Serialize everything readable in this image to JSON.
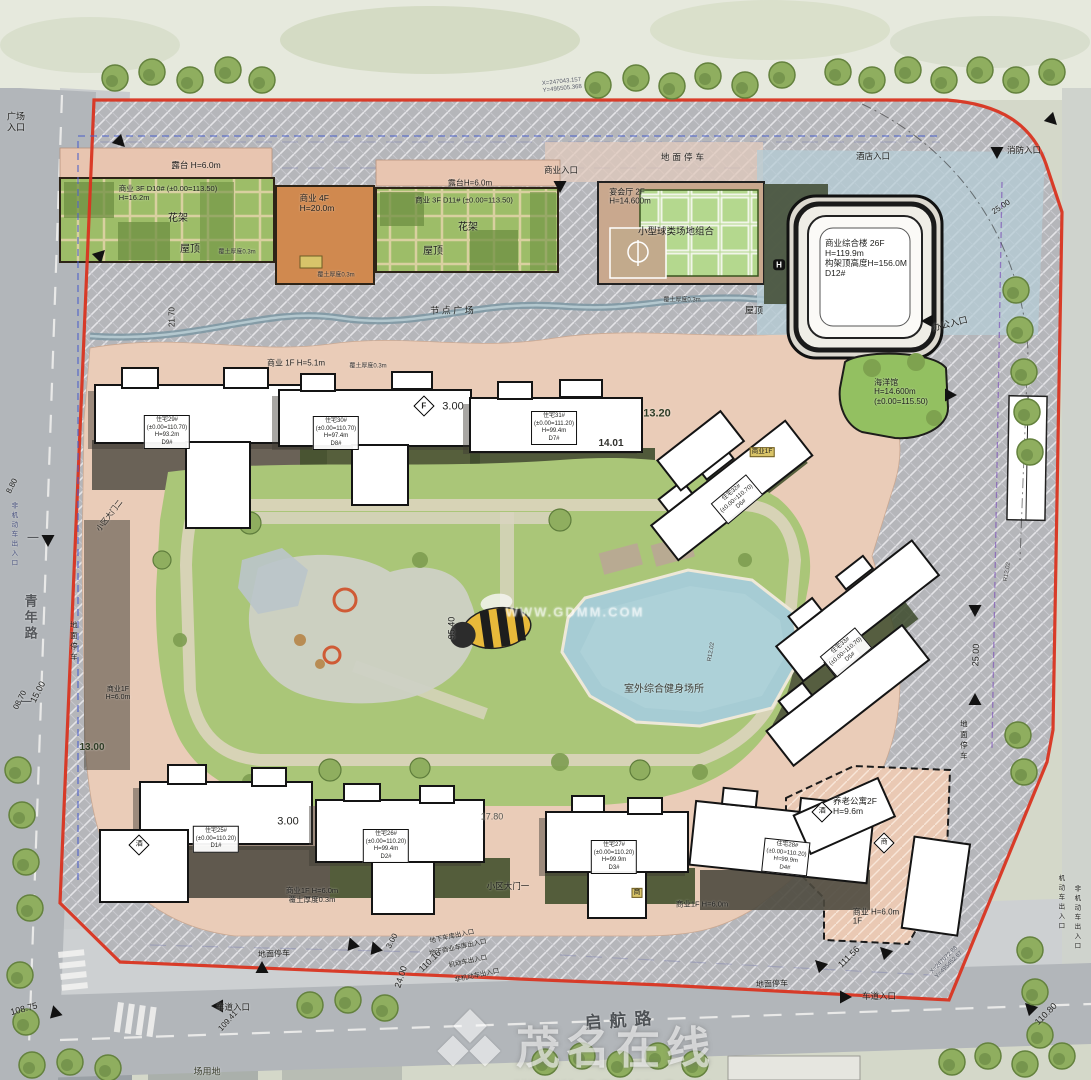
{
  "watermark": {
    "brand": "茂名在线",
    "url": "WWW.GDMM.COM"
  },
  "roads": {
    "left": "青年路",
    "bottom": "启航路"
  },
  "accent_colors": {
    "boundary_red": "#d93420",
    "lawn_green": "#aac678",
    "pool_blue": "#a6ccd4",
    "walk_pink": "#eaccb8"
  },
  "labels": [
    {
      "n": "plaza-entrance-fragment",
      "t": "广场\n入口",
      "x": 16,
      "y": 122,
      "fs": 9
    },
    {
      "n": "terrace-a",
      "t": "露台 H=6.0m",
      "x": 196,
      "y": 165,
      "fs": 8.5
    },
    {
      "n": "shop-d10",
      "t": "商业 3F D10# (±0.00=113.50)\nH=16.2m",
      "x": 168,
      "y": 194,
      "fs": 7.5,
      "cls": "ta-l"
    },
    {
      "n": "pergola-a",
      "t": "花架",
      "x": 178,
      "y": 219,
      "fs": 10
    },
    {
      "n": "roof-a",
      "t": "屋顶",
      "x": 190,
      "y": 250,
      "fs": 10
    },
    {
      "n": "soil-a",
      "t": "覆土厚度0.3m",
      "x": 237,
      "y": 253,
      "fs": 6,
      "c": "#333"
    },
    {
      "n": "shop-4f",
      "t": "商业 4F\nH=20.0m",
      "x": 317,
      "y": 203,
      "fs": 8.5,
      "cls": "ta-l"
    },
    {
      "n": "soil-b",
      "t": "覆土厚度0.3m",
      "x": 336,
      "y": 276,
      "fs": 6,
      "c": "#333"
    },
    {
      "n": "terrace-b",
      "t": "露台H=6.0m",
      "x": 470,
      "y": 183,
      "fs": 8
    },
    {
      "n": "shop-d11",
      "t": "商业 3F D11# (±0.00=113.50)",
      "x": 464,
      "y": 201,
      "fs": 7.5
    },
    {
      "n": "pergola-b",
      "t": "花架",
      "x": 468,
      "y": 228,
      "fs": 10
    },
    {
      "n": "roof-b",
      "t": "屋顶",
      "x": 433,
      "y": 252,
      "fs": 10
    },
    {
      "n": "biz-entrance-top",
      "t": "商业入口",
      "x": 561,
      "y": 170,
      "fs": 8.5
    },
    {
      "n": "banquet-hall",
      "t": "宴会厅 2F\nH=14.600m",
      "x": 630,
      "y": 197,
      "fs": 8,
      "cls": "ta-l"
    },
    {
      "n": "ball-courts",
      "t": "小型球类场地组合",
      "x": 676,
      "y": 232,
      "fs": 9.5
    },
    {
      "n": "soil-c",
      "t": "覆土厚度0.3m",
      "x": 682,
      "y": 301,
      "fs": 6,
      "c": "#333"
    },
    {
      "n": "ground-parking-top",
      "t": "地面停车",
      "x": 684,
      "y": 157,
      "fs": 8.5,
      "ls": 3
    },
    {
      "n": "hotel-entrance",
      "t": "酒店入口",
      "x": 873,
      "y": 156,
      "fs": 8.5
    },
    {
      "n": "fire-entrance",
      "t": "消防入口",
      "x": 1024,
      "y": 150,
      "fs": 8.5
    },
    {
      "n": "coord-top",
      "t": "X=247043.157\nY=495505.368",
      "x": 562,
      "y": 86,
      "fs": 6,
      "r": -6,
      "c": "#565a66",
      "cls": "ta-l"
    },
    {
      "n": "node-plaza",
      "t": "节 点 广 场",
      "x": 452,
      "y": 311,
      "fs": 9
    },
    {
      "n": "dim-21-70",
      "t": "21.70",
      "x": 172,
      "y": 317,
      "fs": 8,
      "r": -90
    },
    {
      "n": "office-entrance",
      "t": "办公入口",
      "x": 950,
      "y": 324,
      "fs": 9,
      "r": -14
    },
    {
      "n": "dim-25-00-top",
      "t": "25.00",
      "x": 1001,
      "y": 207,
      "fs": 8,
      "r": -33
    },
    {
      "n": "roof-c",
      "t": "屋顶",
      "x": 754,
      "y": 311,
      "fs": 9
    },
    {
      "n": "tower-card",
      "t": "商业综合楼 26F\nH=119.9m\n构架顶高度H=156.0M\nD12#",
      "x": 866,
      "y": 258,
      "fs": 8.5,
      "cls": "ta-l"
    },
    {
      "n": "helipad-icon",
      "t": "H",
      "x": 779,
      "y": 265,
      "fs": 8,
      "cls": "hbox",
      "b": 1
    },
    {
      "n": "aquarium",
      "t": "海洋馆\nH=14.600m\n(±0.00=115.50)",
      "x": 901,
      "y": 392,
      "fs": 8,
      "cls": "ta-l"
    },
    {
      "n": "shop-1f-h51",
      "t": "商业 1F H=5.1m",
      "x": 296,
      "y": 363,
      "fs": 8
    },
    {
      "n": "soil-d",
      "t": "覆土厚度0.3m",
      "x": 368,
      "y": 367,
      "fs": 6,
      "c": "#333"
    },
    {
      "n": "f-diamond",
      "t": "F",
      "x": 424,
      "y": 406,
      "fs": 8,
      "cls": "dia",
      "b": 1
    },
    {
      "n": "dim-3-00-a",
      "t": "3.00",
      "x": 453,
      "y": 407,
      "fs": 11
    },
    {
      "n": "dim-13-20",
      "t": "13.20",
      "x": 657,
      "y": 414,
      "fs": 11,
      "c": "#2f3d26",
      "b": 1
    },
    {
      "n": "dim-14-01",
      "t": "14.01",
      "x": 611,
      "y": 444,
      "fs": 10,
      "c": "#30302c",
      "b": 1
    },
    {
      "n": "res-d9",
      "t": "住宅29#\n(±0.00=110.70)\nH=93.2m\nD9#",
      "x": 167,
      "y": 432,
      "fs": 6,
      "cls": "box"
    },
    {
      "n": "res-d8",
      "t": "住宅30#\n(±0.00=110.70)\nH=97.4m\nD8#",
      "x": 336,
      "y": 433,
      "fs": 6,
      "cls": "box"
    },
    {
      "n": "res-d7",
      "t": "住宅31#\n(±0.00=111.20)\nH=99.4m\nD7#",
      "x": 554,
      "y": 428,
      "fs": 6,
      "cls": "box"
    },
    {
      "n": "res-d6",
      "t": "住宅32#\n(±0.00=110.70)\nD6#",
      "x": 737,
      "y": 499,
      "fs": 6,
      "cls": "box",
      "r": -40
    },
    {
      "n": "shop-1f-tag",
      "t": "商业1F",
      "x": 762,
      "y": 452,
      "fs": 6.5,
      "cls": "yellow"
    },
    {
      "n": "res-d5",
      "t": "住宅33#\n(±0.00=110.70)\nD5#",
      "x": 846,
      "y": 652,
      "fs": 6,
      "cls": "box",
      "r": -40
    },
    {
      "n": "dim-95-40",
      "t": "95.40",
      "x": 452,
      "y": 628,
      "fs": 9,
      "r": -90
    },
    {
      "n": "fitness-area",
      "t": "室外综合健身场所",
      "x": 664,
      "y": 690,
      "fs": 10,
      "c": "#3f3f38"
    },
    {
      "n": "road-qingnian",
      "t": "青年路",
      "x": 30,
      "y": 618,
      "fs": 13,
      "cls": "v",
      "b": 1,
      "c": "#55585c"
    },
    {
      "n": "road-dash-a",
      "t": "—",
      "x": 33,
      "y": 538,
      "fs": 11,
      "c": "#55585c",
      "b": 1
    },
    {
      "n": "road-dash-b",
      "t": "—",
      "x": 26,
      "y": 702,
      "fs": 11,
      "c": "#55585c",
      "b": 1
    },
    {
      "n": "parking-left",
      "t": "地面停车",
      "x": 73,
      "y": 642,
      "fs": 7.5,
      "cls": "v"
    },
    {
      "n": "gate-2",
      "t": "小区大门二",
      "x": 110,
      "y": 516,
      "fs": 7.5,
      "r": -52
    },
    {
      "n": "dim-15-00",
      "t": "15.00",
      "x": 38,
      "y": 692,
      "fs": 9,
      "r": -63
    },
    {
      "n": "dim-8-80",
      "t": "8.80",
      "x": 12,
      "y": 486,
      "fs": 8,
      "r": -63
    },
    {
      "n": "dim-08-70",
      "t": "08.70",
      "x": 20,
      "y": 700,
      "fs": 8,
      "r": -63
    },
    {
      "n": "dim-13-00",
      "t": "13.00",
      "x": 92,
      "y": 748,
      "fs": 10,
      "b": 1,
      "c": "#2f3d26"
    },
    {
      "n": "shop-1f-left",
      "t": "商业1F\nH=6.0m",
      "x": 118,
      "y": 694,
      "fs": 7
    },
    {
      "n": "nonmotor-entry-left",
      "t": "非机动车出入口",
      "x": 13,
      "y": 535,
      "fs": 6.5,
      "cls": "v",
      "c": "#47507e"
    },
    {
      "n": "dim-17-80",
      "t": "17.80",
      "x": 492,
      "y": 817,
      "fs": 9,
      "c": "#55554e"
    },
    {
      "n": "dim-3-00-b",
      "t": "3.00",
      "x": 288,
      "y": 822,
      "fs": 11
    },
    {
      "n": "res-d1",
      "t": "住宅25#\n(±0.00=110.20)\nD1#",
      "x": 216,
      "y": 839,
      "fs": 6,
      "cls": "box"
    },
    {
      "n": "res-d2",
      "t": "住宅26#\n(±0.00=110.20)\nH=99.4m\nD2#",
      "x": 386,
      "y": 846,
      "fs": 6,
      "cls": "box"
    },
    {
      "n": "res-d3",
      "t": "住宅27#\n(±0.00=110.20)\nH=99.9m\nD3#",
      "x": 614,
      "y": 857,
      "fs": 6,
      "cls": "box"
    },
    {
      "n": "res-d4",
      "t": "住宅28#\n(±0.00=110.20)\nH=99.9m\nD4#",
      "x": 786,
      "y": 857,
      "fs": 6,
      "cls": "box",
      "r": 6
    },
    {
      "n": "gate-1",
      "t": "小区大门一",
      "x": 508,
      "y": 886,
      "fs": 8.5
    },
    {
      "n": "shop-1f-bottom-a",
      "t": "商业1F H=6.0m\n覆土厚度0.3m",
      "x": 312,
      "y": 896,
      "fs": 7.5
    },
    {
      "n": "shop-1f-bottom-b",
      "t": "商业1F H=6.0m",
      "x": 702,
      "y": 905,
      "fs": 7.5
    },
    {
      "n": "tag-b",
      "t": "商",
      "x": 637,
      "y": 893,
      "fs": 7,
      "cls": "yellow"
    },
    {
      "n": "senior-apartment",
      "t": "养老公寓2F\nH=9.6m",
      "x": 855,
      "y": 806,
      "fs": 8.5,
      "cls": "ta-l"
    },
    {
      "n": "dia-jiu",
      "t": "酒",
      "x": 822,
      "y": 812,
      "fs": 7,
      "cls": "dia"
    },
    {
      "n": "dia-shang",
      "t": "商",
      "x": 884,
      "y": 843,
      "fs": 7,
      "cls": "dia"
    },
    {
      "n": "dia-jiu2",
      "t": "酒",
      "x": 139,
      "y": 845,
      "fs": 7,
      "cls": "dia"
    },
    {
      "n": "shop-1f-right",
      "t": "商业 H=6.0m\n1F",
      "x": 876,
      "y": 917,
      "fs": 8,
      "cls": "ta-l"
    },
    {
      "n": "parking-bottom-a",
      "t": "地面停车",
      "x": 274,
      "y": 954,
      "fs": 8,
      "r": -3
    },
    {
      "n": "dim-3-00-c",
      "t": "3.00",
      "x": 392,
      "y": 941,
      "fs": 8,
      "r": -62
    },
    {
      "n": "underground-parking-entry",
      "t": "地下车库出入口",
      "x": 452,
      "y": 937,
      "fs": 6.5,
      "r": -12
    },
    {
      "n": "underground-biz-entry",
      "t": "地下商业车库出入口",
      "x": 458,
      "y": 948,
      "fs": 6.5,
      "r": -12
    },
    {
      "n": "motor-entry-bottom",
      "t": "机动车出入口",
      "x": 468,
      "y": 962,
      "fs": 6.5,
      "r": -12
    },
    {
      "n": "nonmotor-entry-bottom",
      "t": "非机动车出入口",
      "x": 477,
      "y": 976,
      "fs": 6.5,
      "r": -12
    },
    {
      "n": "lane-entry-left",
      "t": "车道入口",
      "x": 233,
      "y": 1007,
      "fs": 8.5
    },
    {
      "n": "dim-109-41",
      "t": "109.41",
      "x": 228,
      "y": 1021,
      "fs": 8,
      "r": -48
    },
    {
      "n": "dim-24-00",
      "t": "24.00",
      "x": 401,
      "y": 977,
      "fs": 9,
      "r": -72
    },
    {
      "n": "dim-110-16",
      "t": "110.16",
      "x": 430,
      "y": 961,
      "fs": 9,
      "r": -45
    },
    {
      "n": "road-qihang",
      "t": "启航路",
      "x": 622,
      "y": 1021,
      "fs": 17,
      "r": -4,
      "b": 1,
      "c": "#4e5256",
      "ls": 8
    },
    {
      "n": "dim-111-56",
      "t": "111.56",
      "x": 849,
      "y": 957,
      "fs": 9,
      "r": -45
    },
    {
      "n": "parking-bottom-b",
      "t": "地面停车",
      "x": 772,
      "y": 984,
      "fs": 8,
      "r": -3
    },
    {
      "n": "lane-entry-right",
      "t": "车道入口",
      "x": 879,
      "y": 996,
      "fs": 8.5
    },
    {
      "n": "coord-bottom",
      "t": "X=247072.88\nY=495452.67",
      "x": 947,
      "y": 963,
      "fs": 6,
      "r": -45,
      "c": "#565a66",
      "cls": "ta-l"
    },
    {
      "n": "dim-110-80",
      "t": "110.80",
      "x": 1046,
      "y": 1014,
      "fs": 9,
      "r": -45
    },
    {
      "n": "dim-108-75",
      "t": "108.75",
      "x": 24,
      "y": 1009,
      "fs": 9,
      "r": -15
    },
    {
      "n": "dim-25-00-right",
      "t": "25.00",
      "x": 976,
      "y": 655,
      "fs": 9,
      "r": -88
    },
    {
      "n": "parking-right",
      "t": "地面停车",
      "x": 963,
      "y": 741,
      "fs": 7.5,
      "cls": "v"
    },
    {
      "n": "motor-entry-right",
      "t": "机动车出入口",
      "x": 1060,
      "y": 903,
      "fs": 6.5,
      "cls": "v"
    },
    {
      "n": "nonmotor-entry-right",
      "t": "非机动车出入口",
      "x": 1076,
      "y": 918,
      "fs": 6.5,
      "cls": "v"
    },
    {
      "n": "radius-a",
      "t": "R12.02",
      "x": 712,
      "y": 652,
      "fs": 6,
      "r": -80,
      "c": "#444"
    },
    {
      "n": "radius-b",
      "t": "R12.02",
      "x": 1008,
      "y": 572,
      "fs": 6,
      "r": -80,
      "c": "#444"
    },
    {
      "n": "plaza-land-fragment",
      "t": "场用地",
      "x": 207,
      "y": 1072,
      "fs": 9,
      "c": "#3c4030"
    },
    {
      "n": "watermark-mid",
      "t": "WWW.GDMM.COM",
      "x": 575,
      "y": 612,
      "fs": 13,
      "c": "rgba(255,255,255,0.42)",
      "b": 1,
      "ls": 2
    }
  ]
}
